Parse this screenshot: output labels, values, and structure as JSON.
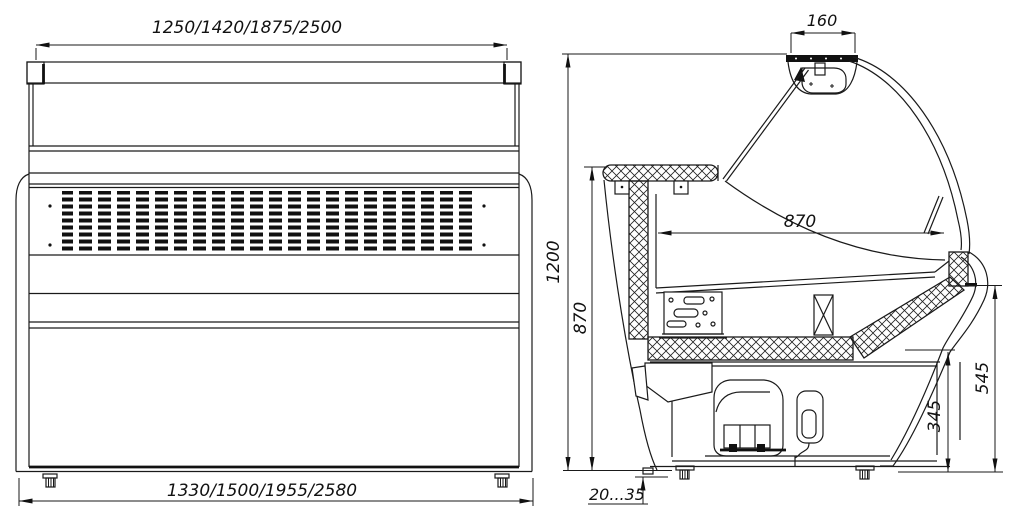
{
  "front_view": {
    "dim_width_top": "1250/1420/1875/2500",
    "dim_width_bottom": "1330/1500/1955/2580"
  },
  "side_view": {
    "dim_canopy_width": "160",
    "dim_overall_height": "1200",
    "dim_worktop_height": "870",
    "dim_display_depth": "870",
    "dim_front_height": "545",
    "dim_base_height": "345",
    "dim_foot_adjust_range": "20...35"
  },
  "colors": {
    "line": "#1a1a1a",
    "background": "#ffffff"
  }
}
